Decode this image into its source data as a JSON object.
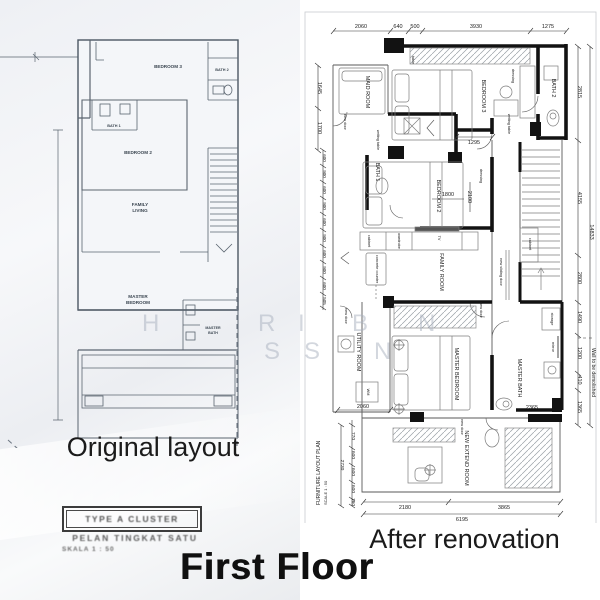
{
  "captions": {
    "original": "Original layout",
    "after": "After renovation",
    "floor": "First Floor"
  },
  "title_block": {
    "line1": "TYPE A CLUSTER",
    "line2": "PELAN TINGKAT SATU",
    "line3": "SKALA 1 : 50"
  },
  "watermark": {
    "letters": [
      "H",
      "R",
      "I",
      "B",
      "N",
      "S",
      "S",
      "N"
    ]
  },
  "original_plan": {
    "rooms": {
      "bedroom3": "BEDROOM 3",
      "bath2": "BATH 2",
      "bath1": "BATH 1",
      "bedroom2": "BEDROOM 2",
      "family1": "FAMILY",
      "family2": "LIVING",
      "master1": "MASTER",
      "master2": "BEDROOM",
      "mbath1": "MASTER",
      "mbath2": "BATH"
    }
  },
  "reno_plan": {
    "plan_title": "FURNITURE LAYOUT PLAN",
    "plan_scale": "SCALE 1 : 50",
    "legend_demolish": "Wall to be demolished",
    "rooms": {
      "maid": "MAID ROOM",
      "bedroom3": "BEDROOM 3",
      "bath2": "BATH 2",
      "bath1": "BATH 1",
      "bedroom2": "BEDROOM 2",
      "family": "FAMILY ROOM",
      "utility": "UTILITY ROOM",
      "master_bedroom": "MASTER BEDROOM",
      "master_bath": "MASTER BATH",
      "new_extend": "NEW EXTEND ROOM"
    },
    "fixtures": {
      "new_door": "new door",
      "new_sliding_door": "new sliding door",
      "concrete_counter": "concrete counter",
      "cabinet": "cabinet",
      "wardrobe": "wardrobe",
      "tv": "TV",
      "wm": "WM",
      "storage": "storage",
      "mirror": "mirror",
      "dressing": "dressing",
      "writing_table": "writing table",
      "table": "table"
    },
    "dims": {
      "top": [
        "2060",
        "640",
        "500",
        "3930",
        "1275"
      ],
      "right": [
        "2815",
        "4155",
        "2800",
        "1490",
        "1200",
        "410",
        "1365"
      ],
      "right_overall": "14833",
      "left_upper": [
        "1645",
        "1700"
      ],
      "left_chain": [
        "600",
        "900",
        "600",
        "900",
        "600",
        "900",
        "600",
        "900",
        "600",
        "505"
      ],
      "left_lower": [
        "770",
        "600",
        "600",
        "600",
        "160"
      ],
      "left_lower_overall": "2730",
      "bottom": [
        "2180",
        "3865"
      ],
      "bottom_overall": "6195",
      "inner": {
        "d1295": "1295",
        "d1800": "1800",
        "d2100": "2100",
        "d2060": "2060",
        "d2365": "2365"
      }
    }
  }
}
